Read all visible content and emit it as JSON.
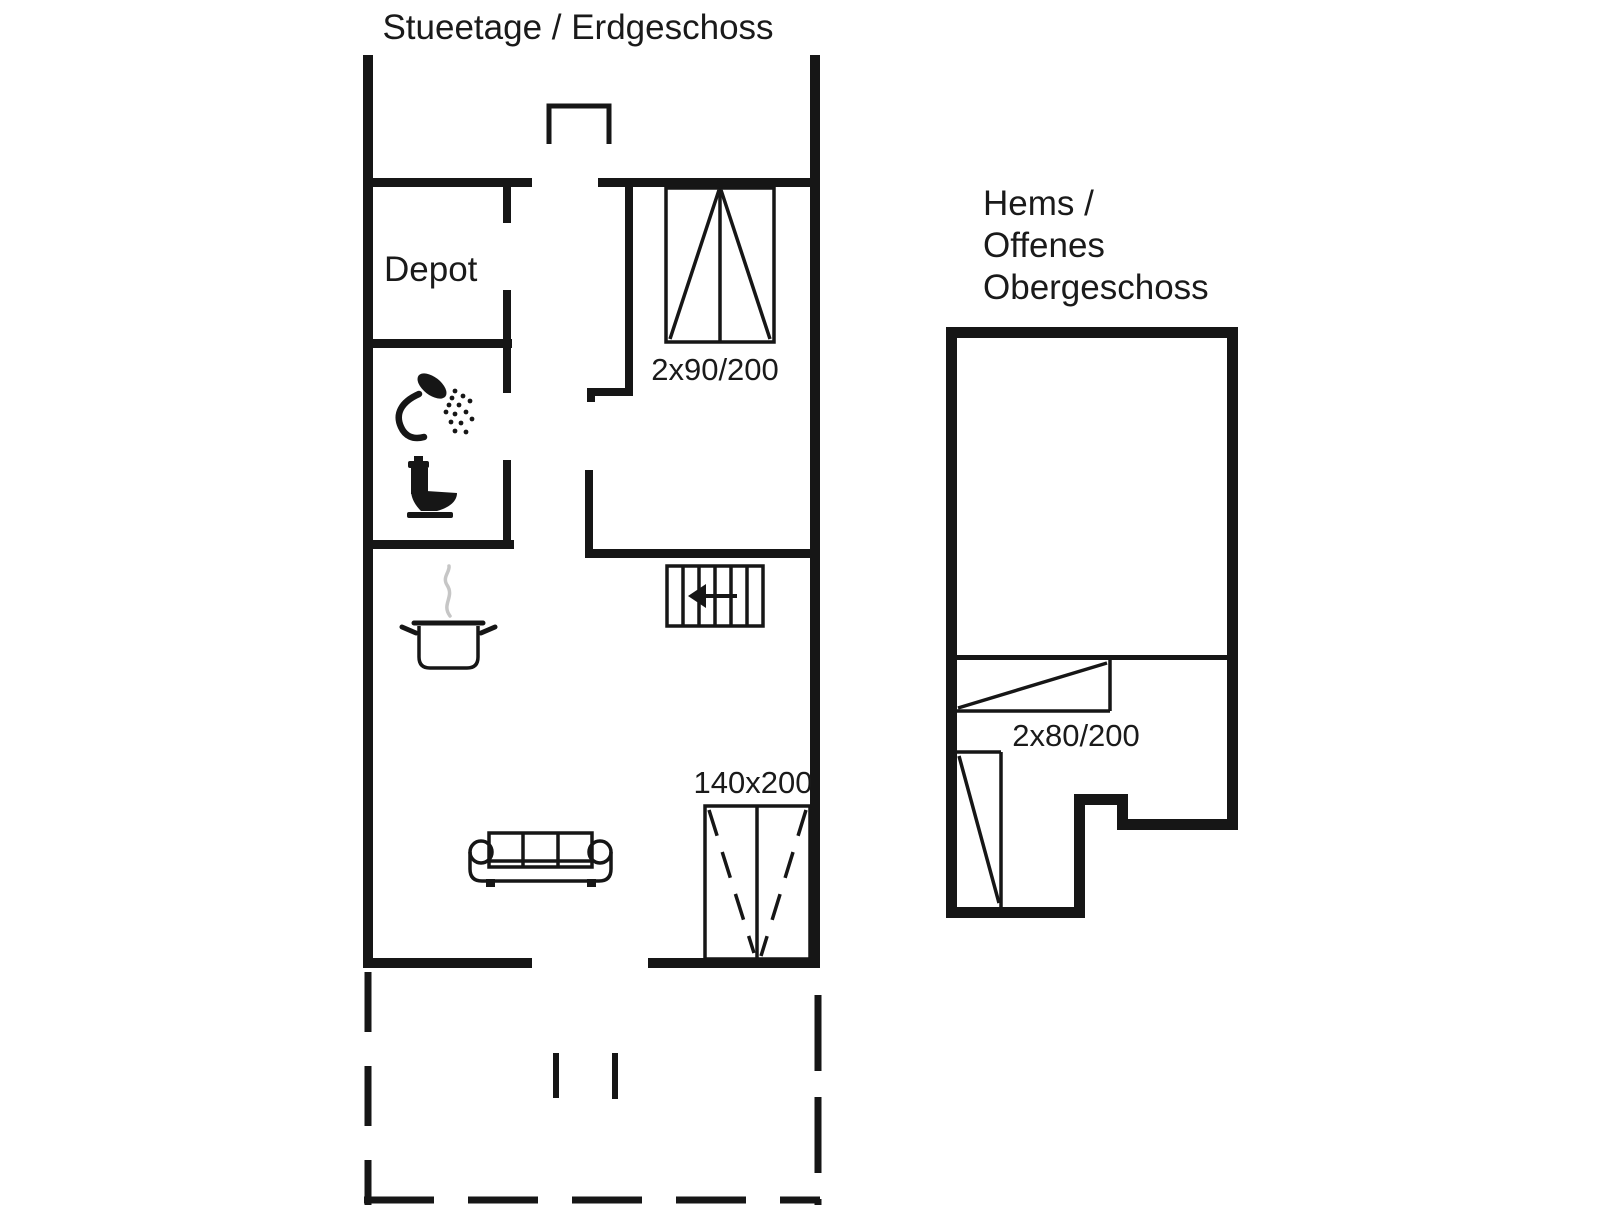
{
  "canvas": {
    "width": 1606,
    "height": 1205,
    "background": "#ffffff",
    "ink_color": "#161616",
    "text_color": "#1a1a1a",
    "steam_color": "#c6c6c6"
  },
  "ground_floor": {
    "title": "Stueetage / Erdgeschoss",
    "depot_label": "Depot",
    "bunk_bed_label": "2x90/200",
    "double_bed_label": "140x200",
    "icons": [
      "shower-icon",
      "toilet-icon",
      "cooking-pot-icon",
      "sofa-icon",
      "stairs-icon",
      "chimney-outline"
    ]
  },
  "loft": {
    "title_lines": [
      "Hems /",
      "Offenes",
      "Obergeschoss"
    ],
    "bed_label": "2x80/200"
  }
}
